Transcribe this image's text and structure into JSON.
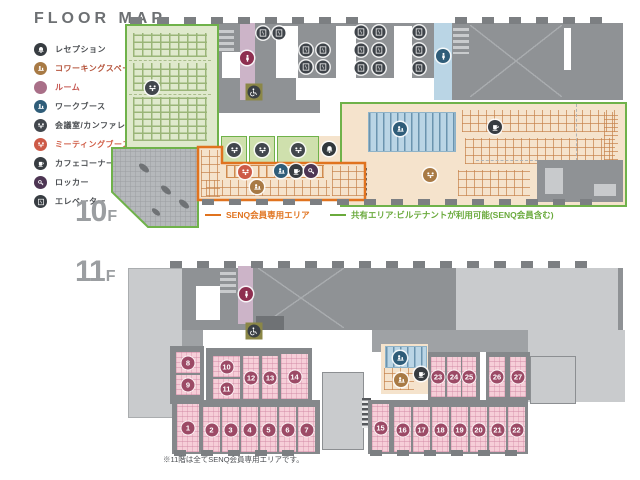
{
  "title": "FLOOR MAP",
  "legend_items": [
    {
      "label": "レセプション",
      "icon": "bell",
      "color": "#383d42",
      "label_color": "#4b4e52"
    },
    {
      "label": "コワーキングスペース",
      "icon": "desk-person",
      "color": "#a87a45",
      "label_color": "#b5543c"
    },
    {
      "label": "ルーム",
      "icon": "none",
      "color": "#a96f88",
      "label_color": "#c4554f"
    },
    {
      "label": "ワークブース",
      "icon": "desk-person",
      "color": "#2f5d79",
      "label_color": "#4b4e52"
    },
    {
      "label": "会議室/カンファレンス",
      "icon": "meeting",
      "color": "#42474d",
      "label_color": "#4b4e52"
    },
    {
      "label": "ミーティングブース",
      "icon": "meeting",
      "color": "#cd5a47",
      "label_color": "#d05c45"
    },
    {
      "label": "カフェコーナー",
      "icon": "cup",
      "color": "#383d42",
      "label_color": "#4b4e52"
    },
    {
      "label": "ロッカー",
      "icon": "key",
      "color": "#4d3553",
      "label_color": "#4b4e52"
    },
    {
      "label": "エレベーター",
      "icon": "elevator",
      "color": "#383d42",
      "label_color": "#4b4e52"
    }
  ],
  "floor_labels": [
    {
      "num": "10",
      "suf": "F"
    },
    {
      "num": "11",
      "suf": "F"
    }
  ],
  "area_legend": [
    {
      "label": "SENQ会員専用エリア",
      "color": "#e0731f"
    },
    {
      "label": "共有エリア:ビルテナントが利用可能(SENQ会員含む)",
      "color": "#6aaa3c"
    }
  ],
  "footnote": "※11階は全てSENQ会員専用エリアです。",
  "colors": {
    "green_fill": "#dfe9cc",
    "shared_border": "#6fb24a",
    "senq_border": "#e0731f",
    "tan_fill": "#f5e3cc",
    "blue_fill": "#bad5e5",
    "pink_room": "#f6ced8",
    "room_badge": "#9c4a66",
    "purple_strip": "#ccb4c8"
  },
  "markers_10f": [
    {
      "t": "conference",
      "g": "meeting",
      "c": "#42474d",
      "x": 152,
      "y": 88
    },
    {
      "t": "restroom-women",
      "g": "person",
      "c": "#8e2f50",
      "x": 247,
      "y": 58
    },
    {
      "t": "accessible-toilet",
      "g": "wheelchair",
      "c": "#8b8747",
      "x": 254,
      "y": 92,
      "shape": "access"
    },
    {
      "t": "elevator",
      "g": "elevator",
      "c": "#3f444a",
      "x": 263,
      "y": 33
    },
    {
      "t": "elevator",
      "g": "elevator",
      "c": "#3f444a",
      "x": 279,
      "y": 33
    },
    {
      "t": "elevator",
      "g": "elevator",
      "c": "#3f444a",
      "x": 306,
      "y": 50
    },
    {
      "t": "elevator",
      "g": "elevator",
      "c": "#3f444a",
      "x": 323,
      "y": 50
    },
    {
      "t": "elevator",
      "g": "elevator",
      "c": "#3f444a",
      "x": 306,
      "y": 67
    },
    {
      "t": "elevator",
      "g": "elevator",
      "c": "#3f444a",
      "x": 323,
      "y": 67
    },
    {
      "t": "elevator",
      "g": "elevator",
      "c": "#3f444a",
      "x": 361,
      "y": 32
    },
    {
      "t": "elevator",
      "g": "elevator",
      "c": "#3f444a",
      "x": 379,
      "y": 32
    },
    {
      "t": "elevator",
      "g": "elevator",
      "c": "#3f444a",
      "x": 361,
      "y": 50
    },
    {
      "t": "elevator",
      "g": "elevator",
      "c": "#3f444a",
      "x": 379,
      "y": 50
    },
    {
      "t": "elevator",
      "g": "elevator",
      "c": "#3f444a",
      "x": 361,
      "y": 68
    },
    {
      "t": "elevator",
      "g": "elevator",
      "c": "#3f444a",
      "x": 379,
      "y": 68
    },
    {
      "t": "elevator",
      "g": "elevator",
      "c": "#3f444a",
      "x": 419,
      "y": 32
    },
    {
      "t": "elevator",
      "g": "elevator",
      "c": "#3f444a",
      "x": 419,
      "y": 50
    },
    {
      "t": "elevator",
      "g": "elevator",
      "c": "#3f444a",
      "x": 419,
      "y": 68
    },
    {
      "t": "restroom-men",
      "g": "person",
      "c": "#2f5d79",
      "x": 443,
      "y": 56
    },
    {
      "t": "conference",
      "g": "meeting",
      "c": "#42474d",
      "x": 234,
      "y": 150
    },
    {
      "t": "conference",
      "g": "meeting",
      "c": "#42474d",
      "x": 262,
      "y": 150
    },
    {
      "t": "conference",
      "g": "meeting",
      "c": "#42474d",
      "x": 298,
      "y": 150
    },
    {
      "t": "reception",
      "g": "bell",
      "c": "#33383d",
      "x": 329,
      "y": 149
    },
    {
      "t": "meeting-booth",
      "g": "meeting",
      "c": "#cd5a47",
      "x": 245,
      "y": 172
    },
    {
      "t": "work-booth",
      "g": "desk-person",
      "c": "#2f5d79",
      "x": 281,
      "y": 171
    },
    {
      "t": "cafe-corner",
      "g": "cup",
      "c": "#373c41",
      "x": 296,
      "y": 171
    },
    {
      "t": "locker",
      "g": "key",
      "c": "#4d3553",
      "x": 311,
      "y": 171
    },
    {
      "t": "coworking",
      "g": "desk-person",
      "c": "#a87a45",
      "x": 257,
      "y": 187
    },
    {
      "t": "work-booth",
      "g": "desk-person",
      "c": "#2f5d79",
      "x": 400,
      "y": 129
    },
    {
      "t": "conference",
      "g": "meeting",
      "c": "#a87a45",
      "x": 430,
      "y": 175
    },
    {
      "t": "cafe-corner",
      "g": "cup",
      "c": "#373c41",
      "x": 495,
      "y": 127
    }
  ],
  "markers_11f": [
    {
      "t": "restroom-women",
      "g": "person",
      "c": "#8e2f50",
      "x": 246,
      "y": 294
    },
    {
      "t": "accessible-toilet",
      "g": "wheelchair",
      "c": "#8b8747",
      "x": 254,
      "y": 331,
      "shape": "access"
    },
    {
      "t": "work-booth",
      "g": "desk-person",
      "c": "#2f5d79",
      "x": 400,
      "y": 358
    },
    {
      "t": "coworking",
      "g": "desk-person",
      "c": "#a87a45",
      "x": 401,
      "y": 380
    },
    {
      "t": "cafe-corner",
      "g": "cup",
      "c": "#373c41",
      "x": 421,
      "y": 374
    }
  ],
  "rooms_11f": [
    {
      "n": "8",
      "x": 176,
      "y": 352,
      "w": 24,
      "h": 21
    },
    {
      "n": "9",
      "x": 176,
      "y": 375,
      "w": 24,
      "h": 20
    },
    {
      "n": "10",
      "x": 213,
      "y": 356,
      "w": 27,
      "h": 21
    },
    {
      "n": "11",
      "x": 213,
      "y": 379,
      "w": 27,
      "h": 20
    },
    {
      "n": "12",
      "x": 243,
      "y": 356,
      "w": 16,
      "h": 43
    },
    {
      "n": "13",
      "x": 262,
      "y": 356,
      "w": 16,
      "h": 43
    },
    {
      "n": "14",
      "x": 281,
      "y": 354,
      "w": 27,
      "h": 45
    },
    {
      "n": "1",
      "x": 177,
      "y": 404,
      "w": 22,
      "h": 48
    },
    {
      "n": "2",
      "x": 203,
      "y": 407,
      "w": 17,
      "h": 45
    },
    {
      "n": "3",
      "x": 222,
      "y": 407,
      "w": 17,
      "h": 45
    },
    {
      "n": "4",
      "x": 241,
      "y": 407,
      "w": 17,
      "h": 45
    },
    {
      "n": "5",
      "x": 260,
      "y": 407,
      "w": 17,
      "h": 45
    },
    {
      "n": "6",
      "x": 279,
      "y": 407,
      "w": 17,
      "h": 45
    },
    {
      "n": "7",
      "x": 298,
      "y": 407,
      "w": 17,
      "h": 45
    },
    {
      "n": "15",
      "x": 372,
      "y": 404,
      "w": 17,
      "h": 48
    },
    {
      "n": "16",
      "x": 394,
      "y": 407,
      "w": 17,
      "h": 45
    },
    {
      "n": "17",
      "x": 413,
      "y": 407,
      "w": 17,
      "h": 45
    },
    {
      "n": "18",
      "x": 432,
      "y": 407,
      "w": 17,
      "h": 45
    },
    {
      "n": "19",
      "x": 451,
      "y": 407,
      "w": 17,
      "h": 45
    },
    {
      "n": "20",
      "x": 470,
      "y": 407,
      "w": 17,
      "h": 45
    },
    {
      "n": "21",
      "x": 489,
      "y": 407,
      "w": 17,
      "h": 45
    },
    {
      "n": "22",
      "x": 508,
      "y": 407,
      "w": 17,
      "h": 45
    },
    {
      "n": "23",
      "x": 431,
      "y": 357,
      "w": 14,
      "h": 40
    },
    {
      "n": "24",
      "x": 447,
      "y": 357,
      "w": 14,
      "h": 40
    },
    {
      "n": "25",
      "x": 462,
      "y": 357,
      "w": 14,
      "h": 40
    },
    {
      "n": "26",
      "x": 489,
      "y": 357,
      "w": 16,
      "h": 40
    },
    {
      "n": "27",
      "x": 510,
      "y": 357,
      "w": 16,
      "h": 40
    }
  ]
}
